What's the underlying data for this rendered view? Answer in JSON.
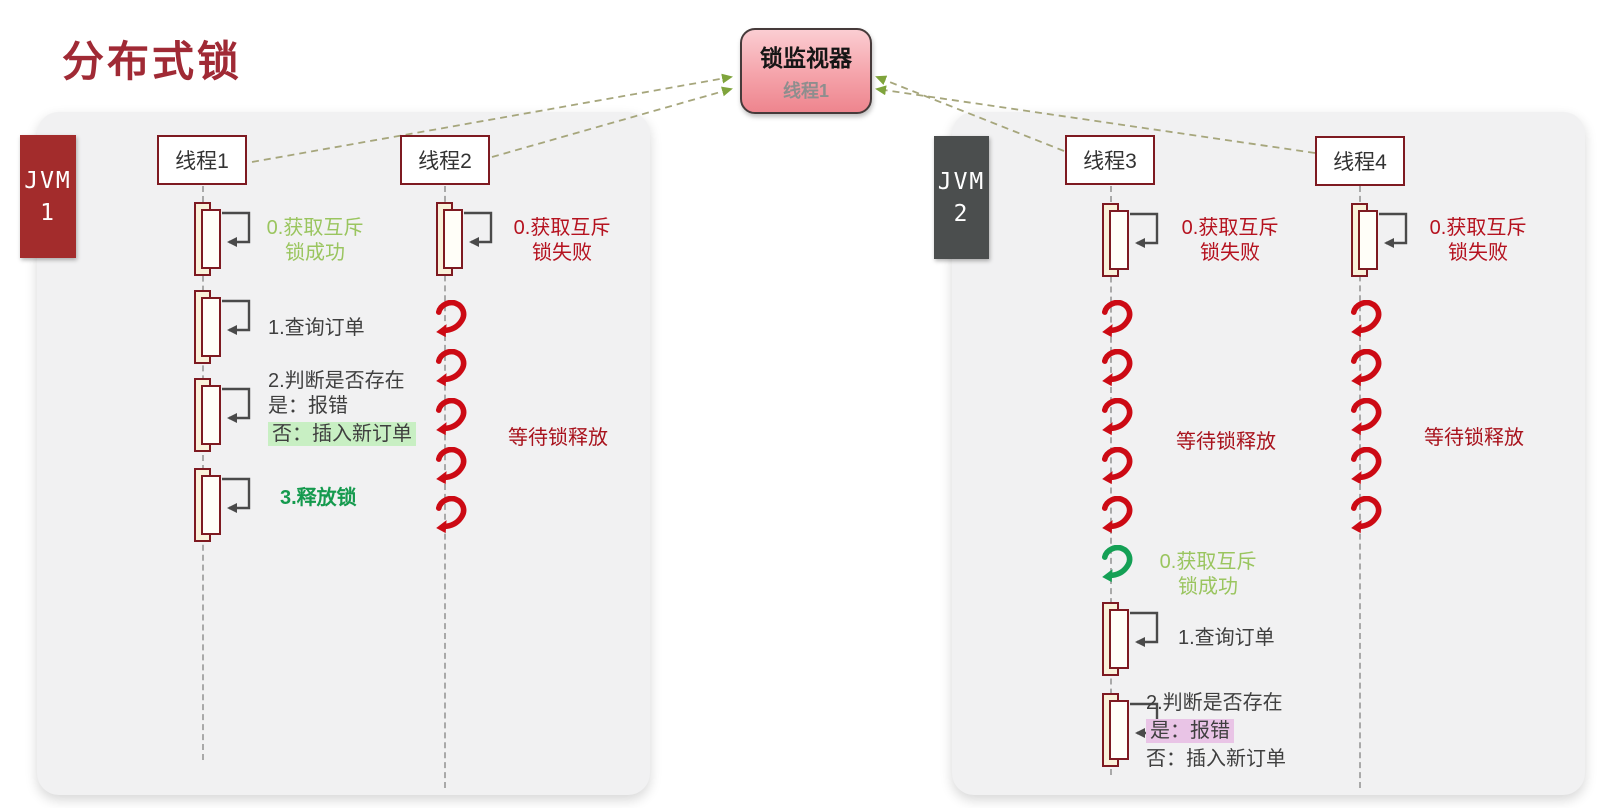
{
  "page": {
    "title": "分布式锁"
  },
  "monitor": {
    "title": "锁监视器",
    "holder": "线程1"
  },
  "jvms": {
    "jvm1": {
      "line1": "JVM",
      "line2": "1"
    },
    "jvm2": {
      "line1": "JVM",
      "line2": "2"
    }
  },
  "threads": {
    "t1": {
      "name": "线程1",
      "acquire_success_l1": "0.获取互斥",
      "acquire_success_l2": "锁成功",
      "query": "1.查询订单",
      "check_l1": "2.判断是否存在",
      "check_yes": "是：报错",
      "check_no": "否：插入新订单",
      "release": "3.释放锁"
    },
    "t2": {
      "name": "线程2",
      "acquire_fail_l1": "0.获取互斥",
      "acquire_fail_l2": "锁失败",
      "wait": "等待锁释放",
      "wait_loops": 5
    },
    "t3": {
      "name": "线程3",
      "acquire_fail_l1": "0.获取互斥",
      "acquire_fail_l2": "锁失败",
      "wait": "等待锁释放",
      "wait_loops": 5,
      "success_loop": 1,
      "acquire_success_l1": "0.获取互斥",
      "acquire_success_l2": "锁成功",
      "query": "1.查询订单",
      "check_l1": "2.判断是否存在",
      "check_yes": "是：报错",
      "check_no": "否：插入新订单"
    },
    "t4": {
      "name": "线程4",
      "acquire_fail_l1": "0.获取互斥",
      "acquire_fail_l2": "锁失败",
      "wait": "等待锁释放",
      "wait_loops": 5
    }
  },
  "colors": {
    "title_red": "#a02a35",
    "jvm1_tab": "#a32c2c",
    "jvm2_tab": "#4b4e4e",
    "thread_border": "#7e1a21",
    "text_red": "#b5121f",
    "text_green_light": "#9ac55f",
    "text_green_dark": "#159a4e",
    "highlight_green": "#c8efc3",
    "highlight_pink": "#e9c4e6",
    "spiral_red": "#cc0a14",
    "spiral_green": "#14a055",
    "connector_arrow_green": "#7fa43c",
    "monitor_fill_top": "#fbcdd2",
    "monitor_fill_bottom": "#ee858e"
  }
}
